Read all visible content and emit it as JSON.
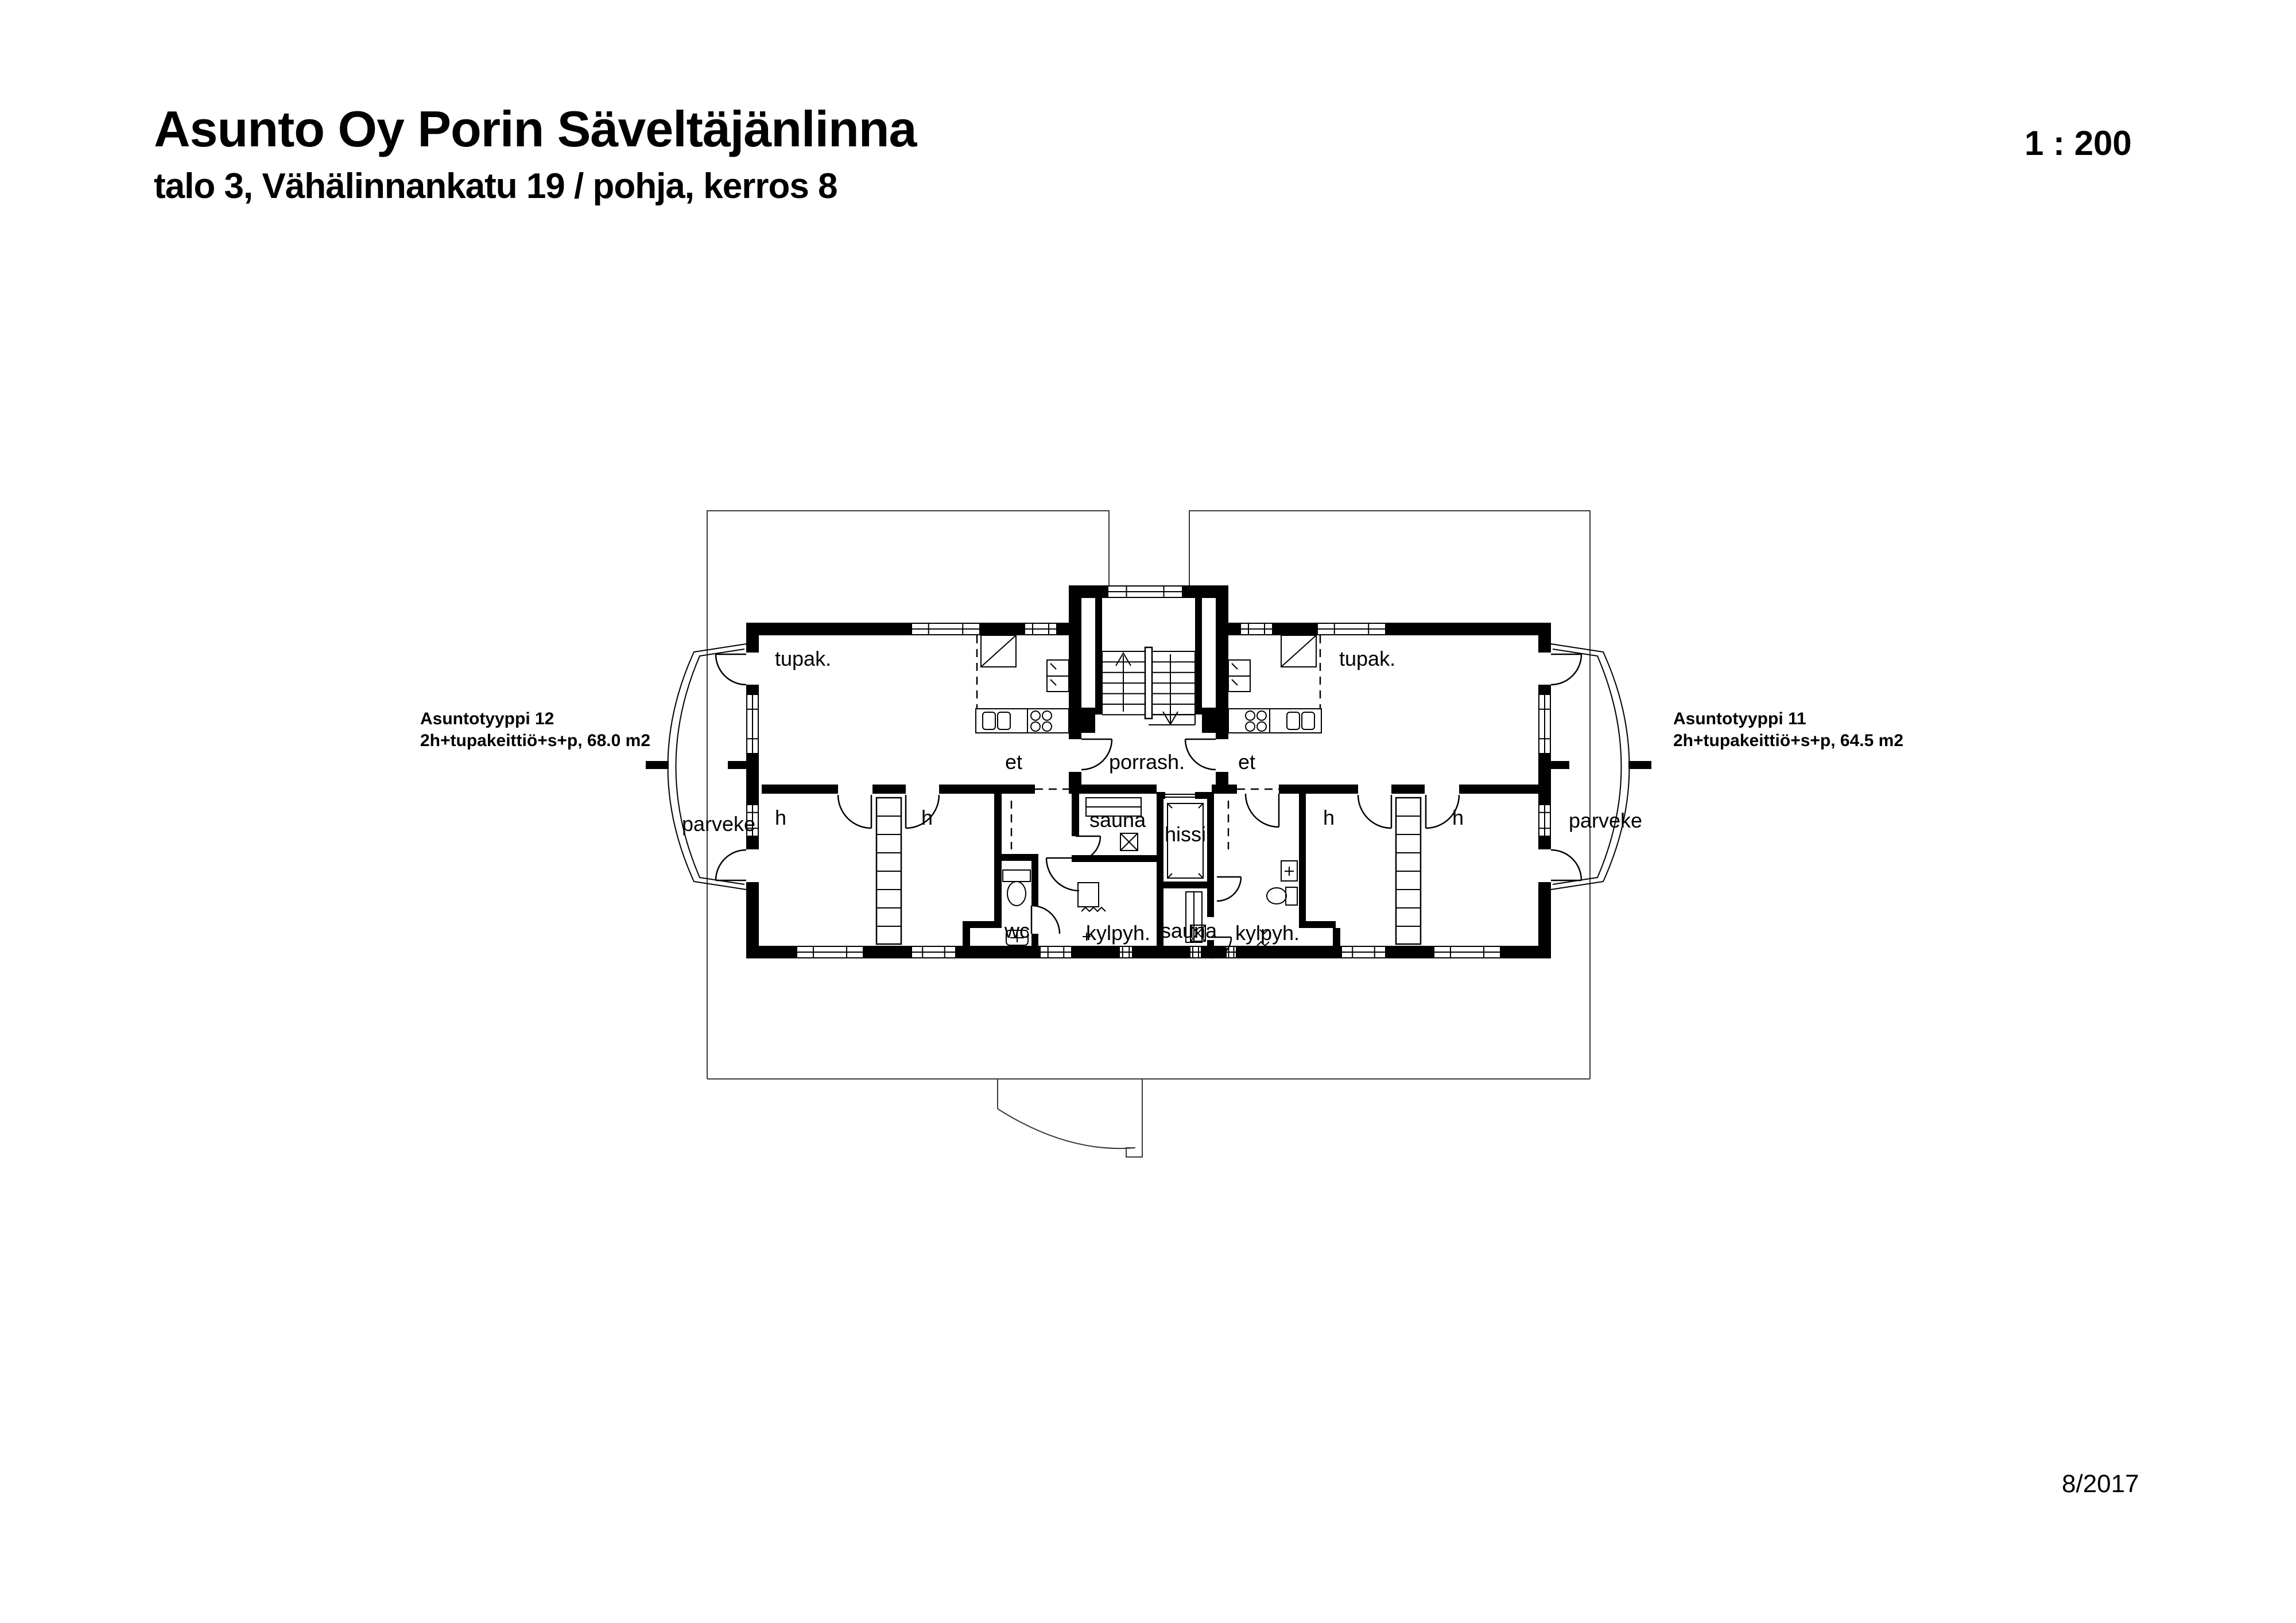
{
  "header": {
    "title": "Asunto Oy Porin Säveltäjänlinna",
    "subtitle": "talo 3, Vähälinnankatu 19 / pohja, kerros 8",
    "scale": "1 : 200"
  },
  "footer": {
    "date": "8/2017"
  },
  "apartments": {
    "left": {
      "name": "Asuntotyyppi 12",
      "spec": "2h+tupakeittiö+s+p, 68.0 m2"
    },
    "right": {
      "name": "Asuntotyyppi 11",
      "spec": "2h+tupakeittiö+s+p, 64.5 m2"
    }
  },
  "rooms": {
    "tupak": "tupak.",
    "et": "et",
    "porrash": "porrash.",
    "parveke": "parveke",
    "h": "h",
    "sauna": "sauna",
    "hissi": "hissi",
    "wc": "wc",
    "kylpyh": "kylpyh."
  },
  "colors": {
    "ink": "#000000",
    "paper": "#ffffff"
  }
}
